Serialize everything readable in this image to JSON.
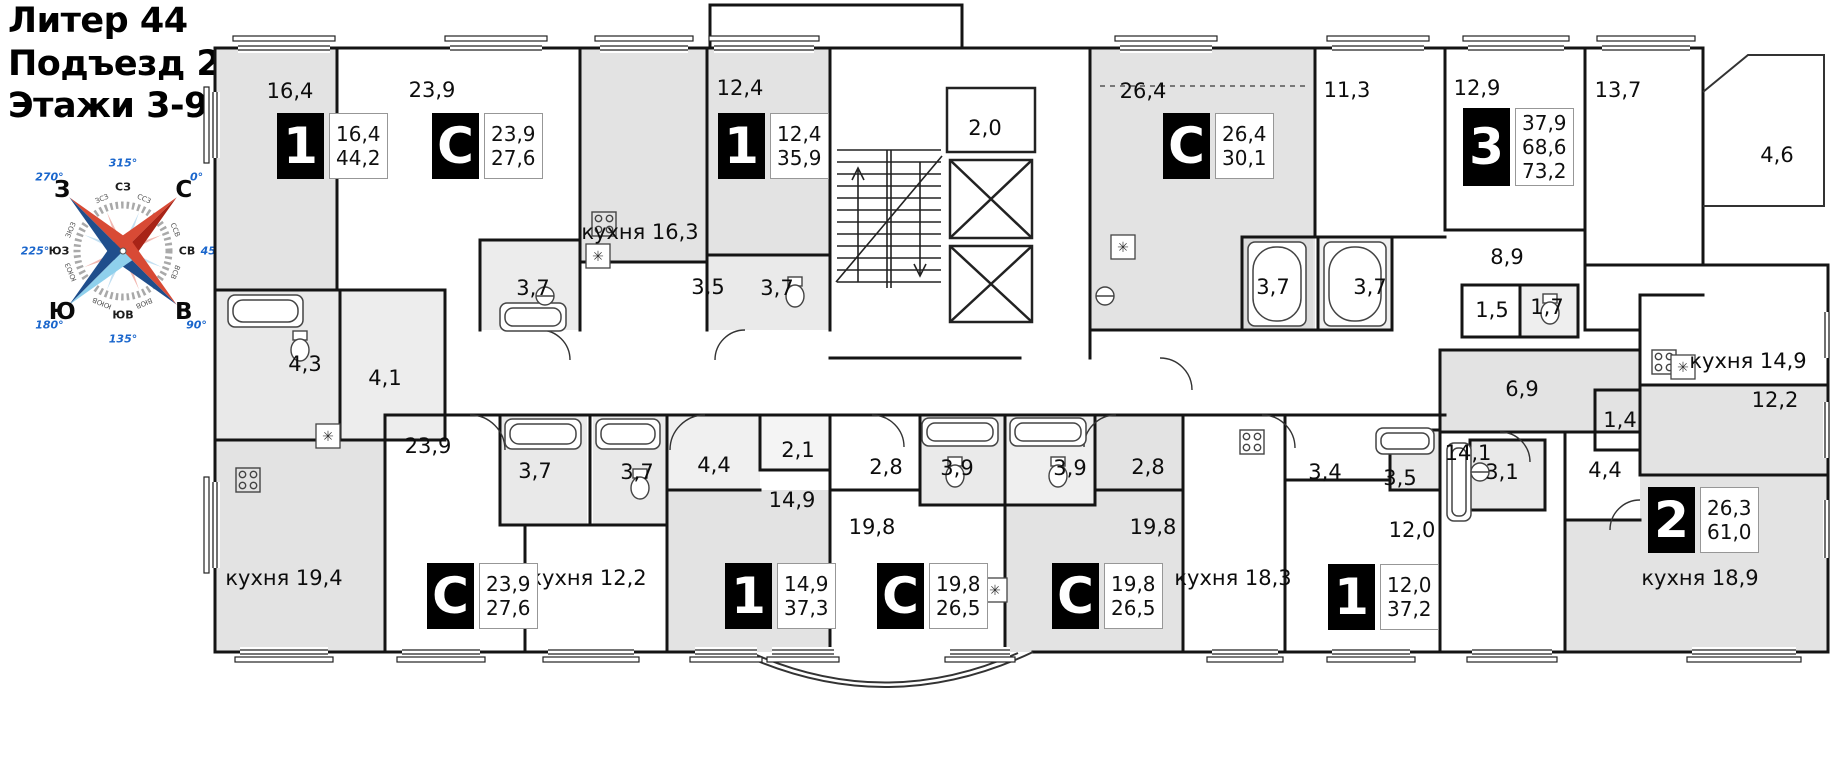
{
  "header": {
    "title_lines": [
      "Литер 44",
      "Подъезд 2",
      "Этажи 3-9"
    ]
  },
  "compass": {
    "points": [
      {
        "label": "С",
        "deg": "0°",
        "bearing": 0
      },
      {
        "label": "СВ",
        "deg": "45°",
        "bearing": 45
      },
      {
        "label": "В",
        "deg": "90°",
        "bearing": 90
      },
      {
        "label": "ЮВ",
        "deg": "135°",
        "bearing": 135
      },
      {
        "label": "Ю",
        "deg": "180°",
        "bearing": 180
      },
      {
        "label": "ЮЗ",
        "deg": "225°",
        "bearing": 225
      },
      {
        "label": "З",
        "deg": "270°",
        "bearing": 270
      },
      {
        "label": "СЗ",
        "deg": "315°",
        "bearing": 315
      }
    ],
    "ring_labels": [
      {
        "label": "ССВ",
        "bearing": 22.5
      },
      {
        "label": "ВСВ",
        "bearing": 67.5
      },
      {
        "label": "ВЮВ",
        "bearing": 112.5
      },
      {
        "label": "ЮЮВ",
        "bearing": 157.5
      },
      {
        "label": "ЮЮЗ",
        "bearing": 202.5
      },
      {
        "label": "ЗЮЗ",
        "bearing": 247.5
      },
      {
        "label": "ЗСЗ",
        "bearing": 292.5
      },
      {
        "label": "ССЗ",
        "bearing": 337.5
      }
    ],
    "colors": {
      "red": "#d84a35",
      "dark_red": "#a82417",
      "blue": "#1f4e8c",
      "light_blue": "#8fd0ec",
      "pale_red": "#f2b9b2",
      "pale_blue": "#c3e0f2",
      "degree_blue": "#1a66cc",
      "ring_gray": "#9a9a9a"
    }
  },
  "plan": {
    "labels": [
      {
        "text": "16,4",
        "x": 290,
        "y": 91
      },
      {
        "text": "23,9",
        "x": 432,
        "y": 90
      },
      {
        "text": "12,4",
        "x": 740,
        "y": 88
      },
      {
        "text": "2,0",
        "x": 985,
        "y": 128
      },
      {
        "text": "26,4",
        "x": 1143,
        "y": 91
      },
      {
        "text": "11,3",
        "x": 1347,
        "y": 90
      },
      {
        "text": "12,9",
        "x": 1477,
        "y": 88
      },
      {
        "text": "13,7",
        "x": 1618,
        "y": 90
      },
      {
        "text": "4,6",
        "x": 1777,
        "y": 155
      },
      {
        "text": "кухня 16,3",
        "x": 640,
        "y": 232
      },
      {
        "text": "3,7",
        "x": 533,
        "y": 288
      },
      {
        "text": "3,5",
        "x": 708,
        "y": 287
      },
      {
        "text": "3,7",
        "x": 777,
        "y": 288
      },
      {
        "text": "3,7",
        "x": 1273,
        "y": 287
      },
      {
        "text": "3,7",
        "x": 1370,
        "y": 287
      },
      {
        "text": "8,9",
        "x": 1507,
        "y": 257
      },
      {
        "text": "1,5",
        "x": 1492,
        "y": 310
      },
      {
        "text": "1,7",
        "x": 1547,
        "y": 307
      },
      {
        "text": "4,3",
        "x": 305,
        "y": 364
      },
      {
        "text": "4,1",
        "x": 385,
        "y": 378
      },
      {
        "text": "кухня 14,9",
        "x": 1748,
        "y": 361
      },
      {
        "text": "12,2",
        "x": 1775,
        "y": 400
      },
      {
        "text": "6,9",
        "x": 1522,
        "y": 389
      },
      {
        "text": "1,4",
        "x": 1620,
        "y": 420
      },
      {
        "text": "23,9",
        "x": 428,
        "y": 446
      },
      {
        "text": "3,7",
        "x": 535,
        "y": 471
      },
      {
        "text": "3,7",
        "x": 637,
        "y": 472
      },
      {
        "text": "4,4",
        "x": 714,
        "y": 465
      },
      {
        "text": "2,1",
        "x": 798,
        "y": 450
      },
      {
        "text": "14,9",
        "x": 792,
        "y": 500
      },
      {
        "text": "2,8",
        "x": 886,
        "y": 467
      },
      {
        "text": "3,9",
        "x": 957,
        "y": 468
      },
      {
        "text": "19,8",
        "x": 872,
        "y": 527
      },
      {
        "text": "3,9",
        "x": 1070,
        "y": 468
      },
      {
        "text": "2,8",
        "x": 1148,
        "y": 467
      },
      {
        "text": "19,8",
        "x": 1153,
        "y": 527
      },
      {
        "text": "3,4",
        "x": 1325,
        "y": 472
      },
      {
        "text": "3,5",
        "x": 1400,
        "y": 478
      },
      {
        "text": "12,0",
        "x": 1412,
        "y": 530
      },
      {
        "text": "14,1",
        "x": 1468,
        "y": 453
      },
      {
        "text": "3,1",
        "x": 1502,
        "y": 472
      },
      {
        "text": "4,4",
        "x": 1605,
        "y": 470
      },
      {
        "text": "кухня 19,4",
        "x": 284,
        "y": 578
      },
      {
        "text": "кухня 12,2",
        "x": 588,
        "y": 578
      },
      {
        "text": "кухня 18,3",
        "x": 1233,
        "y": 578
      },
      {
        "text": "кухня 18,9",
        "x": 1700,
        "y": 578
      }
    ],
    "badges": [
      {
        "type": "1",
        "x": 277,
        "y": 113,
        "areas": [
          "16,4",
          "44,2"
        ]
      },
      {
        "type": "С",
        "x": 432,
        "y": 113,
        "areas": [
          "23,9",
          "27,6"
        ]
      },
      {
        "type": "1",
        "x": 718,
        "y": 113,
        "areas": [
          "12,4",
          "35,9"
        ]
      },
      {
        "type": "С",
        "x": 1163,
        "y": 113,
        "areas": [
          "26,4",
          "30,1"
        ]
      },
      {
        "type": "3",
        "x": 1463,
        "y": 108,
        "areas": [
          "37,9",
          "68,6",
          "73,2"
        ]
      },
      {
        "type": "С",
        "x": 427,
        "y": 563,
        "areas": [
          "23,9",
          "27,6"
        ]
      },
      {
        "type": "1",
        "x": 725,
        "y": 563,
        "areas": [
          "14,9",
          "37,3"
        ]
      },
      {
        "type": "С",
        "x": 877,
        "y": 563,
        "areas": [
          "19,8",
          "26,5"
        ]
      },
      {
        "type": "С",
        "x": 1052,
        "y": 563,
        "areas": [
          "19,8",
          "26,5"
        ]
      },
      {
        "type": "1",
        "x": 1328,
        "y": 564,
        "areas": [
          "12,0",
          "37,2"
        ]
      },
      {
        "type": "2",
        "x": 1648,
        "y": 487,
        "areas": [
          "26,3",
          "61,0"
        ]
      }
    ]
  }
}
